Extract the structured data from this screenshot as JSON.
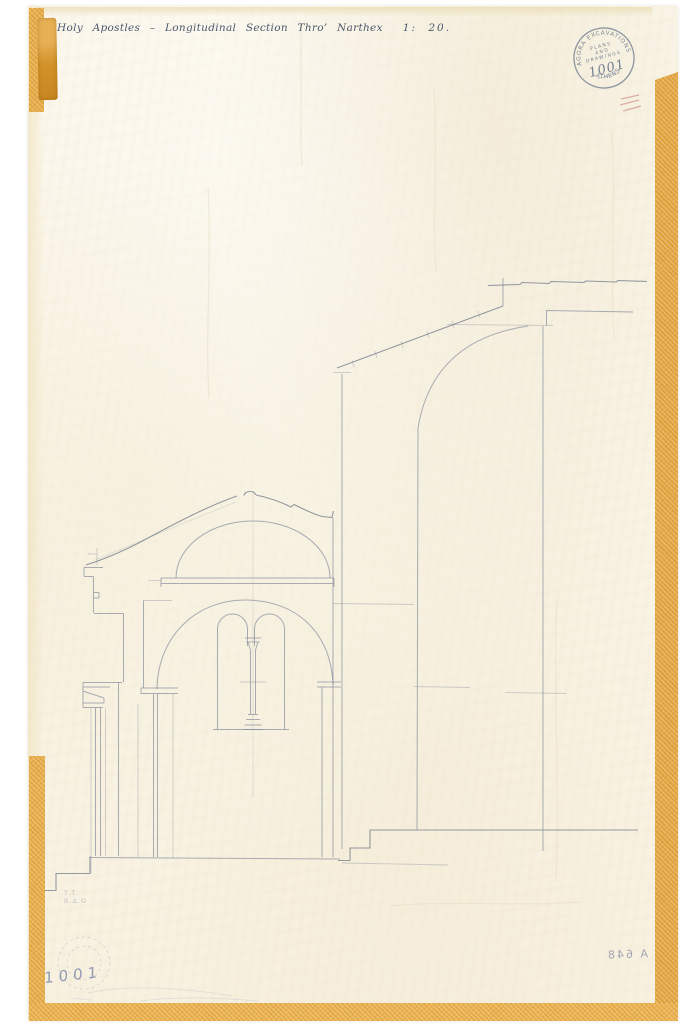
{
  "title": {
    "main": "Holy Apostles – Longitudinal Section Thro’ Narthex",
    "scale": "1: 20."
  },
  "stamp": {
    "arc_top": "AGORA EXCAVATIONS",
    "arc_bottom": "· ATHENS ·",
    "line1": "PLANS",
    "line2": "AND",
    "line3": "DRAWINGS",
    "number": "1001"
  },
  "annotations": {
    "bottom_left_number": "1001",
    "bottom_right_mirrored": "A 648",
    "faint_note_line1": "T.T.",
    "faint_note_line2": "B.Δ.O"
  },
  "colors": {
    "paper": "#faf5e8",
    "tape": "#e3a43e",
    "ink": "#33435c",
    "pencil": "#828b9b",
    "stamp_ink": "#64748a",
    "red_mark": "#c9847a"
  }
}
